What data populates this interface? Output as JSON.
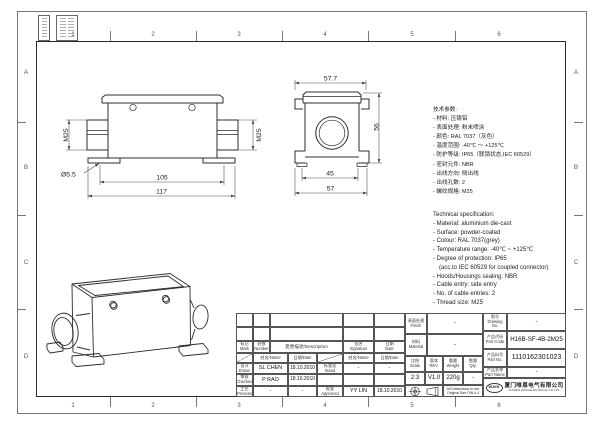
{
  "sheet": {
    "zones_top": [
      "1",
      "2",
      "3",
      "4",
      "5",
      "6"
    ],
    "zones_bottom": [
      "1",
      "2",
      "3",
      "4",
      "5",
      "6"
    ],
    "rows_left": [
      "A",
      "B",
      "C",
      "D"
    ],
    "rows_right": [
      "A",
      "B",
      "C",
      "D"
    ]
  },
  "front": {
    "m25_left": "M25",
    "m25_right": "M25",
    "dia": "Ø5.5",
    "d_inner": "105",
    "d_outer": "117"
  },
  "side": {
    "d_top": "57.7",
    "d_height": "56",
    "d_inner": "45",
    "d_outer": "57"
  },
  "spec_cn": {
    "title": "技术参数:",
    "lines": [
      "- 材料: 压铸铝",
      "- 表面处理: 粉末喷涂",
      "- 颜色: RAL 7037（灰色）",
      "- 温度范围: -40℃ ～ +125℃",
      "- 防护等级: IP65（联锁状态,IEC 60529）",
      "- 密封元件: NBR",
      "- 出线方向: 侧出线",
      "- 出线孔数: 2",
      "- 螺纹规格: M25"
    ]
  },
  "spec_en": {
    "title": "Technical specification:",
    "lines": [
      "- Material: aluminium die-cast",
      "- Surface: powder-coated",
      "- Colour: RAL 7037(grey)",
      "- Temperature range: -40℃ ~ +125℃",
      "- Degree of protection: IP65",
      "(acc.to IEC 60529 for coupled connector)",
      "- Hoods/Housings sealing: NBR",
      "- Cable entry: side entry",
      "- No. of cable entries: 2",
      "- Thread size: M25"
    ]
  },
  "tb": {
    "mark_cn": "标记",
    "mark_en": "Mark",
    "number_cn": "处数",
    "number_en": "Number",
    "desc": "变更描述/Description",
    "sig_cn": "签名",
    "sig_en": "Signature",
    "date_cn": "日期",
    "date_en": "Date",
    "name_hdr": "姓名/Name",
    "date_hdr": "日期/Date",
    "drawn_cn": "设计",
    "drawn_en": "Drawn",
    "drawn_name": "SL CHEN",
    "drawn_date": "18.10.2010",
    "checked_cn": "审核",
    "checked_en": "Checked",
    "checked_name": "P RAO",
    "checked_date": "18.10.2010",
    "process_cn": "工艺",
    "process_en": "Process",
    "process_name": "-",
    "process_date": "-",
    "stand_cn": "标准化",
    "stand_en": "Stand",
    "stand_name": "-",
    "stand_date": "-",
    "approved_cn": "批准",
    "approved_en": "Approved",
    "approved_name": "YY LIN",
    "approved_date": "18.10.2010",
    "finish_cn": "表面处理",
    "finish_en": "Finish",
    "finish_val": "-",
    "material_cn": "材料",
    "material_en": "Material",
    "material_val": "-",
    "scale_cn": "比例",
    "scale_en": "Scale",
    "scale_val": "2:3",
    "rev_cn": "版本",
    "rev_en": "REV.",
    "rev_val": "V1.0",
    "weight_cn": "重量",
    "weight_en": "Weight",
    "weight_val": "220g",
    "qty_cn": "数量",
    "qty_en": "Qty.",
    "qty_val": "-",
    "drawing_no_cn": "图号",
    "drawing_no_en": "Drawing No.",
    "drawing_no_val": "-",
    "part_code_cn": "产品代码",
    "part_code_en": "Part Code",
    "part_code_val": "H16B-SF-4B-2M25",
    "part_no_cn": "产品料号",
    "part_no_en": "Part No.",
    "part_no_val": "1110162301023",
    "part_name_cn": "产品名称",
    "part_name_en": "Part Name",
    "part_name_val": "-",
    "note_1": "All Dimensions in mm",
    "note_2": "Original Size DIN A 4",
    "logo_text": "WAIN",
    "company_cn": "厦门唯恩电气有限公司",
    "company_en": "XIAMEN WAIN ELECTRICAL CO.LTD"
  }
}
